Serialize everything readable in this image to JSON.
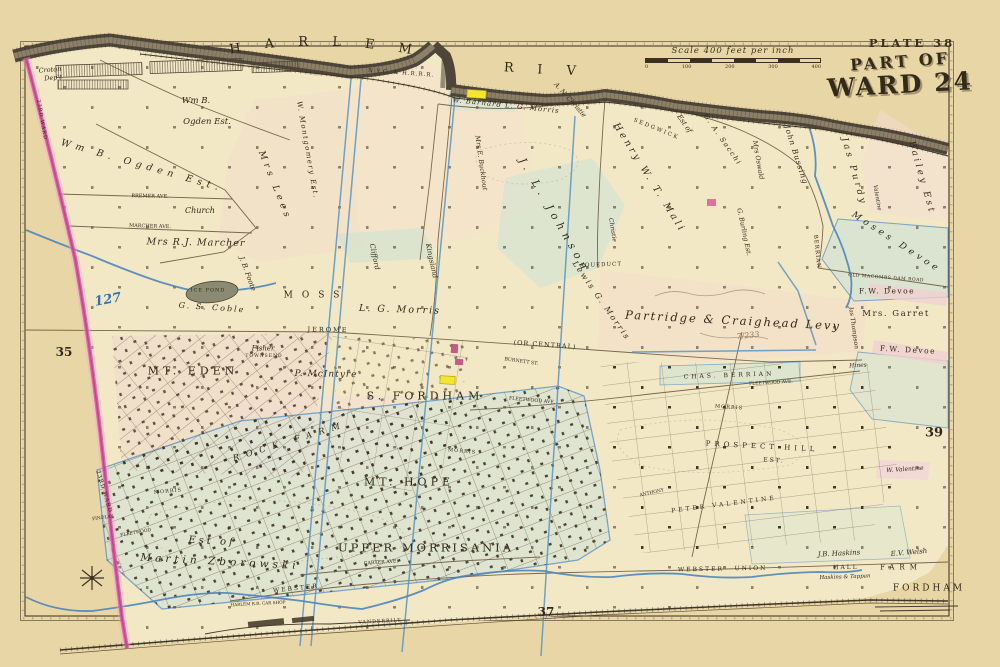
{
  "plate": {
    "number": "PLATE 38",
    "title_line1": "PART OF",
    "title_line2": "WARD 24"
  },
  "scale": {
    "label": "Scale 400 feet per inch",
    "ticks": [
      "0",
      "100",
      "200",
      "300",
      "400"
    ]
  },
  "river": {
    "name": "HARLEM RIVER",
    "railroad_label": "N.Y.C. & H.R.R.R."
  },
  "palette": {
    "page_cream": "#e9d6a6",
    "land_cream": "#f2e8c6",
    "parcel_pink": "#f3dcc9",
    "parcel_green": "#d7e3d4",
    "highlight_yellow": "#f2e62e",
    "ward_boundary_pink": "#d64f9e",
    "water_blue": "#4b86bb",
    "river_dark": "#4f463a",
    "ink": "#32291a"
  },
  "map": {
    "labels": [
      {
        "t": "Croton",
        "x": 50,
        "y": 70,
        "s": 6.5,
        "r": -5,
        "c": "it"
      },
      {
        "t": "Dep't",
        "x": 53,
        "y": 78,
        "s": 6.5,
        "r": -5,
        "c": "it"
      },
      {
        "t": "Wm B.",
        "x": 196,
        "y": 101,
        "s": 8.5,
        "c": "it"
      },
      {
        "t": "Ogden Est.",
        "x": 207,
        "y": 122,
        "s": 8.5,
        "c": "it"
      },
      {
        "t": "Wm B. Ogden Est.",
        "x": 142,
        "y": 166,
        "s": 9.5,
        "r": 16,
        "ls": 5,
        "c": "it"
      },
      {
        "t": "Mrs Lees",
        "x": 274,
        "y": 186,
        "s": 9,
        "r": 68,
        "ls": 4,
        "c": "it"
      },
      {
        "t": "W. Montgomery Est.",
        "x": 307,
        "y": 150,
        "s": 7,
        "r": 80,
        "ls": 1.5,
        "c": "it"
      },
      {
        "t": "Church",
        "x": 200,
        "y": 211,
        "s": 8,
        "c": "it"
      },
      {
        "t": "BREMER AVE.",
        "x": 150,
        "y": 197,
        "s": 5,
        "r": 1
      },
      {
        "t": "MARCHER AVE.",
        "x": 150,
        "y": 227,
        "s": 5,
        "r": 2
      },
      {
        "t": "Mrs R.J. Marcher",
        "x": 196,
        "y": 243,
        "s": 9.5,
        "r": 1,
        "ls": 1,
        "c": "it"
      },
      {
        "t": "127",
        "x": 108,
        "y": 300,
        "s": 13,
        "r": -10,
        "c": "blue"
      },
      {
        "t": "35",
        "x": 64,
        "y": 352,
        "s": 12,
        "c": "bold"
      },
      {
        "t": "23RD WARD",
        "x": 41,
        "y": 120,
        "s": 5,
        "r": 80,
        "ls": 1
      },
      {
        "t": "23RD WARD",
        "x": 103,
        "y": 492,
        "s": 5.5,
        "r": 73,
        "ls": 1
      },
      {
        "t": "ICE POND",
        "x": 208,
        "y": 291,
        "s": 5,
        "ls": 1
      },
      {
        "t": "G. S. Coble",
        "x": 212,
        "y": 308,
        "s": 8,
        "r": 4,
        "ls": 2,
        "c": "it"
      },
      {
        "t": "J. B. Foote",
        "x": 247,
        "y": 274,
        "s": 7,
        "r": 70,
        "c": "it"
      },
      {
        "t": "MOSS",
        "x": 316,
        "y": 296,
        "s": 9,
        "ls": 9
      },
      {
        "t": "L. G. Morris",
        "x": 400,
        "y": 310,
        "s": 9.5,
        "r": 2,
        "ls": 2,
        "c": "it"
      },
      {
        "t": "Kingsland",
        "x": 431,
        "y": 261,
        "s": 7,
        "r": 78,
        "c": "it"
      },
      {
        "t": "Clifford",
        "x": 374,
        "y": 257,
        "s": 7,
        "r": 78,
        "c": "it"
      },
      {
        "t": "JEROME",
        "x": 328,
        "y": 330,
        "s": 6.5,
        "ls": 2,
        "r": 1
      },
      {
        "t": "(OR CENTRAL)",
        "x": 545,
        "y": 345,
        "s": 6.5,
        "r": 4,
        "ls": 1
      },
      {
        "t": "AQUEDUCT",
        "x": 601,
        "y": 266,
        "s": 5.5,
        "r": -2,
        "ls": 1
      },
      {
        "t": "Lewis G. Morris",
        "x": 601,
        "y": 301,
        "s": 8,
        "r": 55,
        "ls": 2,
        "c": "it"
      },
      {
        "t": "MT. EDEN",
        "x": 193,
        "y": 371,
        "s": 11,
        "ls": 4
      },
      {
        "t": "Fisher",
        "x": 263,
        "y": 349,
        "s": 7,
        "c": "it"
      },
      {
        "t": "TOWNSEND",
        "x": 264,
        "y": 357,
        "s": 4.5,
        "ls": 1
      },
      {
        "t": "P. McIntyre",
        "x": 326,
        "y": 375,
        "s": 9,
        "r": 1,
        "ls": 1,
        "c": "it"
      },
      {
        "t": "S. FORDHAM",
        "x": 425,
        "y": 396,
        "s": 11,
        "ls": 4
      },
      {
        "t": "BURNETT ST.",
        "x": 521,
        "y": 363,
        "s": 4.8,
        "r": 8
      },
      {
        "t": "FLEETWOOD AVE.",
        "x": 532,
        "y": 402,
        "s": 4.8,
        "r": 5
      },
      {
        "t": "MORRIS",
        "x": 462,
        "y": 452,
        "s": 5,
        "r": 5,
        "ls": 1
      },
      {
        "t": "MT. HOPE",
        "x": 409,
        "y": 482,
        "s": 11,
        "ls": 4
      },
      {
        "t": "ROCK FARM",
        "x": 290,
        "y": 442,
        "s": 8.5,
        "r": -17,
        "ls": 7,
        "c": "it"
      },
      {
        "t": "UPPER MORRISANIA",
        "x": 426,
        "y": 548,
        "s": 11.5,
        "ls": 3
      },
      {
        "t": "CARTER AVE.",
        "x": 381,
        "y": 564,
        "s": 4.8,
        "r": -4
      },
      {
        "t": "WEBSTER",
        "x": 296,
        "y": 589,
        "s": 6,
        "r": -6,
        "ls": 2
      },
      {
        "t": "VANDERBILT",
        "x": 380,
        "y": 623,
        "s": 4.8,
        "r": -3,
        "ls": 1
      },
      {
        "t": "HARLEM R.R. CAR SHOP",
        "x": 258,
        "y": 604,
        "s": 4.2,
        "r": -3
      },
      {
        "t": "Est of",
        "x": 212,
        "y": 542,
        "s": 10,
        "r": 3,
        "ls": 3,
        "c": "it"
      },
      {
        "t": "Martin Zborowski",
        "x": 220,
        "y": 562,
        "s": 10.5,
        "r": 3,
        "ls": 4,
        "c": "it"
      },
      {
        "t": "MORRIS",
        "x": 168,
        "y": 492,
        "s": 5,
        "r": -5,
        "ls": 1
      },
      {
        "t": "FINDLAY",
        "x": 103,
        "y": 519,
        "s": 4.5,
        "r": -8
      },
      {
        "t": "FLEETWOOD",
        "x": 136,
        "y": 534,
        "s": 4.5,
        "r": -10
      },
      {
        "t": "Partridge & Craighead Levy",
        "x": 733,
        "y": 321,
        "s": 11.5,
        "r": 3,
        "ls": 2,
        "c": "it"
      },
      {
        "t": "7/233",
        "x": 748,
        "y": 336,
        "s": 8,
        "r": -6,
        "c": "pencil"
      },
      {
        "t": "Jas Thompson",
        "x": 853,
        "y": 328,
        "s": 6,
        "r": 82,
        "c": "it"
      },
      {
        "t": "OLD MACOMBS DAM ROAD",
        "x": 886,
        "y": 279,
        "s": 4.5,
        "r": 4,
        "ls": 0.5
      },
      {
        "t": "F.W. Devoe",
        "x": 887,
        "y": 291,
        "s": 7.5,
        "ls": 1.5
      },
      {
        "t": "Mrs. Garret",
        "x": 896,
        "y": 314,
        "s": 8.5,
        "ls": 1.5
      },
      {
        "t": "F.W. Devoe",
        "x": 908,
        "y": 350,
        "s": 7.5,
        "r": 3,
        "ls": 1.5
      },
      {
        "t": "Moses Devoe",
        "x": 896,
        "y": 243,
        "s": 9,
        "r": 33,
        "ls": 4,
        "c": "it"
      },
      {
        "t": "Jas Purdy",
        "x": 853,
        "y": 172,
        "s": 9,
        "r": 74,
        "ls": 3,
        "c": "it"
      },
      {
        "t": "Bailey Est",
        "x": 921,
        "y": 178,
        "s": 9,
        "r": 74,
        "ls": 3,
        "c": "it"
      },
      {
        "t": "Valentine",
        "x": 876,
        "y": 198,
        "s": 5.5,
        "r": 80,
        "c": "it"
      },
      {
        "t": "John Bussing",
        "x": 796,
        "y": 155,
        "s": 7.5,
        "r": 72,
        "ls": 1,
        "c": "it"
      },
      {
        "t": "Mrs Oswald",
        "x": 758,
        "y": 160,
        "s": 6.5,
        "r": 80,
        "c": "it"
      },
      {
        "t": "Est of",
        "x": 684,
        "y": 124,
        "s": 7,
        "r": 55,
        "c": "it"
      },
      {
        "t": "G. A. Sacchi",
        "x": 722,
        "y": 140,
        "s": 7,
        "r": 55,
        "ls": 1.5,
        "c": "it"
      },
      {
        "t": "Henry W. T. Mali",
        "x": 649,
        "y": 178,
        "s": 9.5,
        "r": 58,
        "ls": 3,
        "c": "it"
      },
      {
        "t": "J. L. Johnson",
        "x": 554,
        "y": 216,
        "s": 10.5,
        "r": 60,
        "ls": 5,
        "c": "it"
      },
      {
        "t": "Christie",
        "x": 612,
        "y": 230,
        "s": 6,
        "r": 80,
        "c": "it"
      },
      {
        "t": "A. N. Christie",
        "x": 570,
        "y": 100,
        "s": 6.5,
        "r": 48,
        "c": "it"
      },
      {
        "t": "W. Barnard L. G. Morris",
        "x": 506,
        "y": 106,
        "s": 7,
        "r": 6,
        "ls": 1,
        "c": "it"
      },
      {
        "t": "SEDGWICK",
        "x": 656,
        "y": 130,
        "s": 5.5,
        "r": 22,
        "ls": 2
      },
      {
        "t": "Mrs E. Buckhout",
        "x": 481,
        "y": 163,
        "s": 6.5,
        "r": 82,
        "c": "it"
      },
      {
        "t": "G. Burling Est.",
        "x": 744,
        "y": 232,
        "s": 6.5,
        "r": 78,
        "c": "it"
      },
      {
        "t": "BERRIAN",
        "x": 816,
        "y": 252,
        "s": 5.5,
        "r": 84,
        "ls": 1
      },
      {
        "t": "CHAS. BERRIAN",
        "x": 729,
        "y": 376,
        "s": 6,
        "ls": 3,
        "r": -2
      },
      {
        "t": "FLEETWOOD AVE.",
        "x": 771,
        "y": 384,
        "s": 4.5,
        "r": -3
      },
      {
        "t": "Hines",
        "x": 858,
        "y": 366,
        "s": 6,
        "r": -3,
        "c": "it"
      },
      {
        "t": "MORRIS",
        "x": 729,
        "y": 408,
        "s": 5,
        "r": 4,
        "ls": 1
      },
      {
        "t": "PROSPECT HILL",
        "x": 762,
        "y": 447,
        "s": 7,
        "ls": 4,
        "r": 3
      },
      {
        "t": "EST.",
        "x": 774,
        "y": 461,
        "s": 6,
        "ls": 2,
        "r": 3
      },
      {
        "t": "PETER VALENTINE",
        "x": 724,
        "y": 505,
        "s": 6,
        "r": -7,
        "ls": 3
      },
      {
        "t": "W. Valentine",
        "x": 905,
        "y": 470,
        "s": 6,
        "r": -4,
        "c": "it"
      },
      {
        "t": "ANTHONY",
        "x": 652,
        "y": 494,
        "s": 4.5,
        "r": -12
      },
      {
        "t": "J.B. Haskins",
        "x": 839,
        "y": 554,
        "s": 7,
        "r": -3,
        "c": "it"
      },
      {
        "t": "Haskins & Tappan",
        "x": 845,
        "y": 578,
        "s": 5.5,
        "r": -2,
        "c": "it"
      },
      {
        "t": "E.V. Welsh",
        "x": 909,
        "y": 553,
        "s": 7,
        "r": -5,
        "c": "it"
      },
      {
        "t": "FARM",
        "x": 901,
        "y": 568,
        "s": 7,
        "ls": 5
      },
      {
        "t": "FORDHAM",
        "x": 929,
        "y": 589,
        "s": 9,
        "ls": 3
      },
      {
        "t": "WEBSTER",
        "x": 701,
        "y": 570,
        "s": 6,
        "ls": 2,
        "r": -1
      },
      {
        "t": "UNION",
        "x": 751,
        "y": 569,
        "s": 6,
        "ls": 2,
        "r": -1
      },
      {
        "t": "HALL",
        "x": 846,
        "y": 568,
        "s": 6,
        "ls": 2,
        "r": -1
      },
      {
        "t": "37",
        "x": 546,
        "y": 612,
        "s": 12,
        "c": "bold"
      },
      {
        "t": "39",
        "x": 934,
        "y": 433,
        "s": 13,
        "c": "bold"
      }
    ]
  }
}
